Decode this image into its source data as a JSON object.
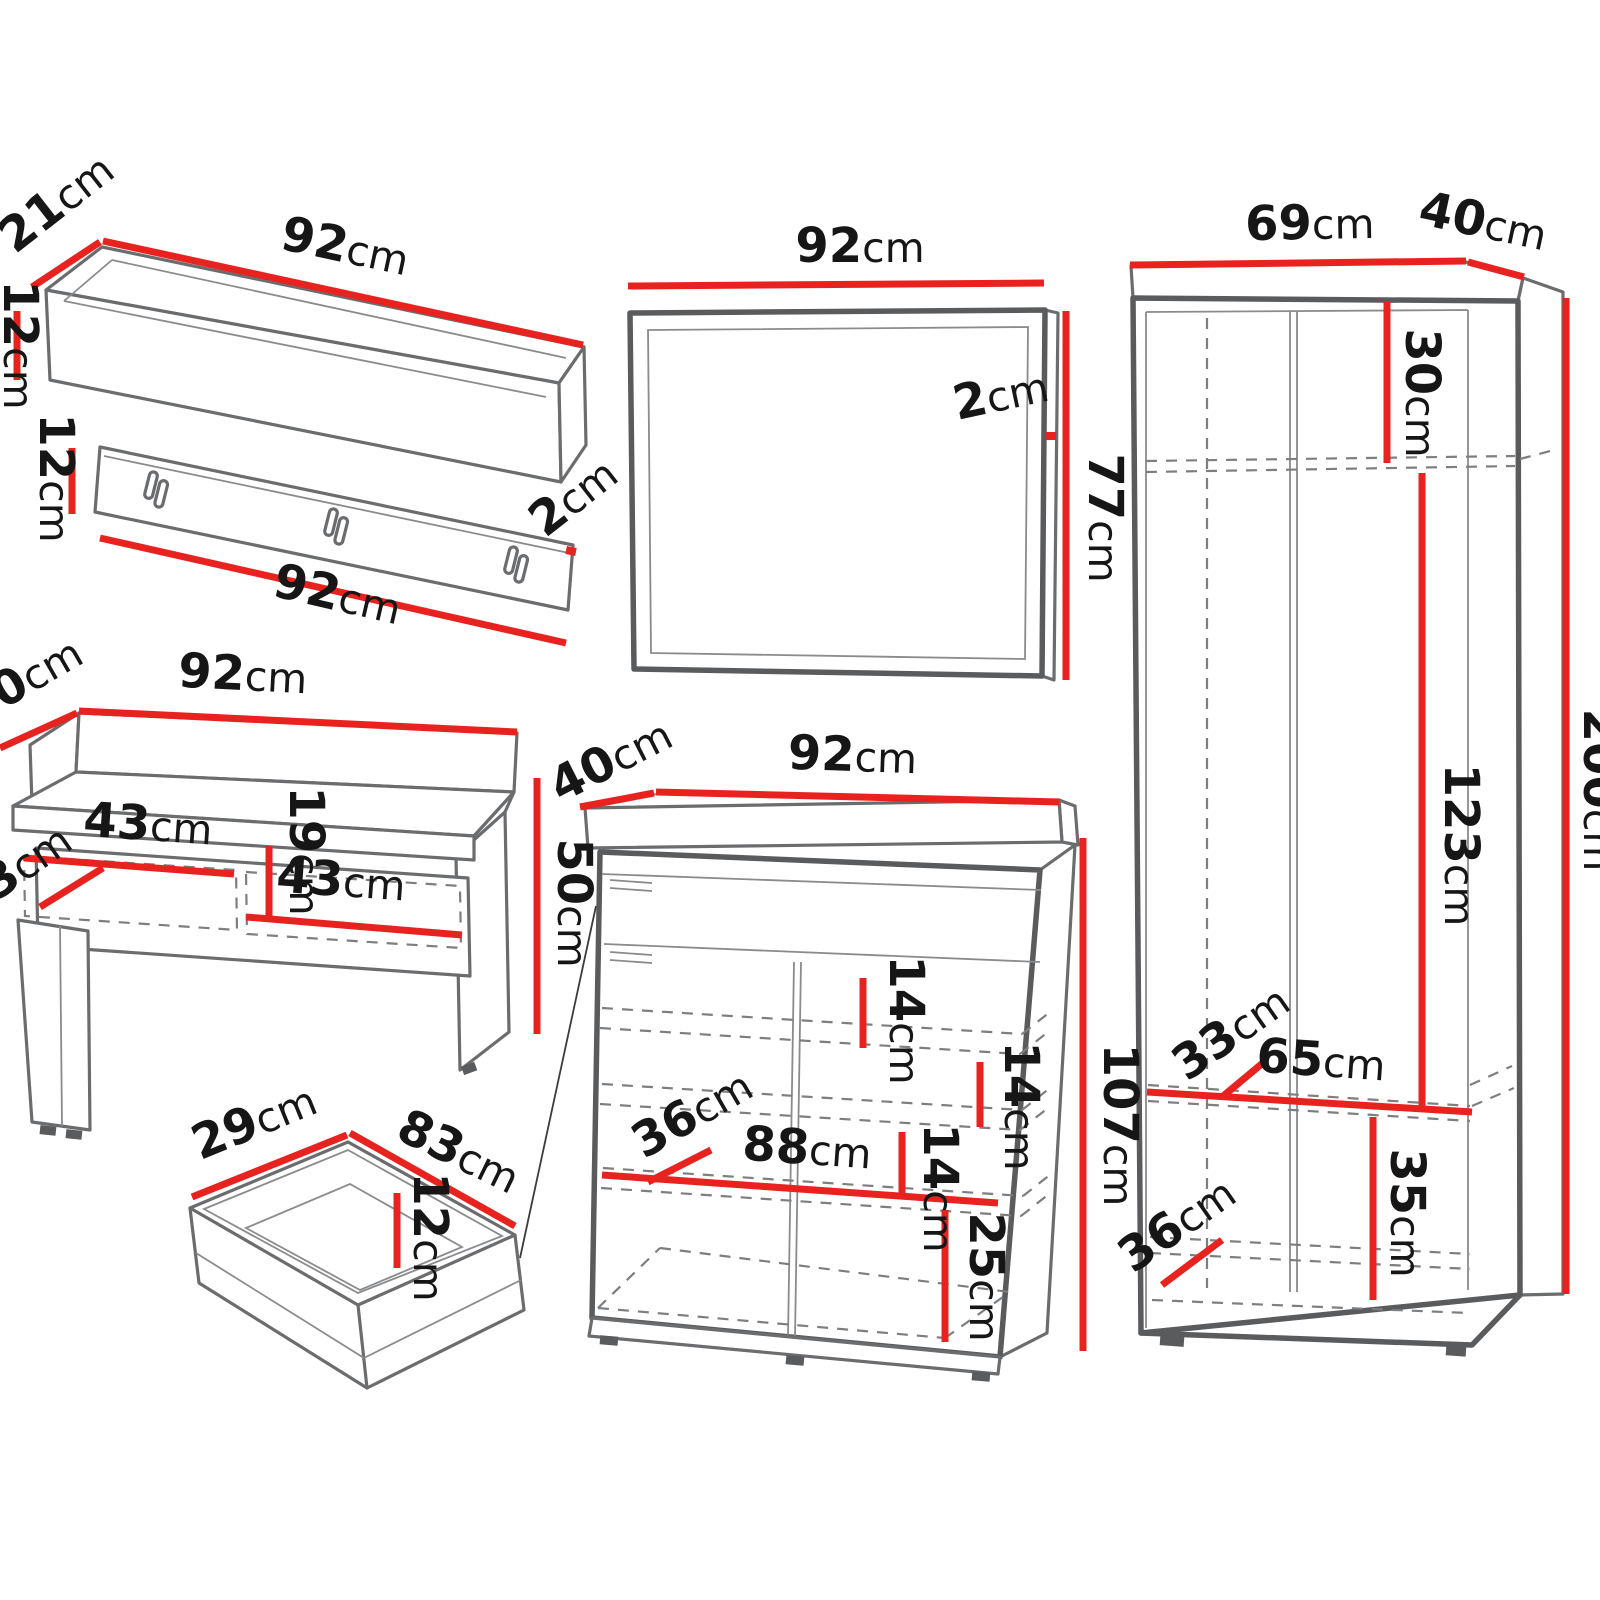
{
  "page": {
    "type": "furniture-dimension-diagram",
    "background": "#ffffff"
  },
  "colors": {
    "dimension_line": "#e8231f",
    "outline": "#6b6c6e",
    "label_text": "#161616"
  },
  "pieces": {
    "wall_shelf": {
      "label": "wall-shelf",
      "depth": "21cm",
      "width": "92cm",
      "height": "12cm"
    },
    "coat_rack": {
      "label": "coat-hook-panel",
      "height": "12cm",
      "width": "92cm",
      "thickness": "2cm",
      "hook_count": 3
    },
    "mirror": {
      "label": "mirror",
      "width": "92cm",
      "thickness": "2cm",
      "height": "77cm"
    },
    "wardrobe": {
      "label": "wardrobe",
      "width": "69cm",
      "depth": "40cm",
      "top_compartment_height": "30cm",
      "hanging_space_height": "123cm",
      "total_height": "200cm",
      "shelf_depth": "33cm",
      "shelf_width": "65cm",
      "bottom_compartment_height": "35cm",
      "base_depth": "36cm"
    },
    "bench": {
      "label": "bench",
      "depth": "40cm",
      "width": "92cm",
      "left_compartment_width": "43cm",
      "right_compartment_width": "43cm",
      "compartment_height": "19cm",
      "compartment_depth": "33cm",
      "height": "50cm"
    },
    "drawer": {
      "label": "pull-out-drawer",
      "depth": "29cm",
      "width": "83cm",
      "height": "12cm"
    },
    "shoe_cabinet": {
      "label": "shoe-cabinet",
      "depth": "40cm",
      "width": "92cm",
      "shelf_spacing_top": "14cm",
      "shelf_spacing_middle": "14cm",
      "shelf_spacing_lower": "14cm",
      "inner_depth": "36cm",
      "inner_width": "88cm",
      "bottom_compartment_height": "25cm",
      "height": "107cm"
    }
  }
}
